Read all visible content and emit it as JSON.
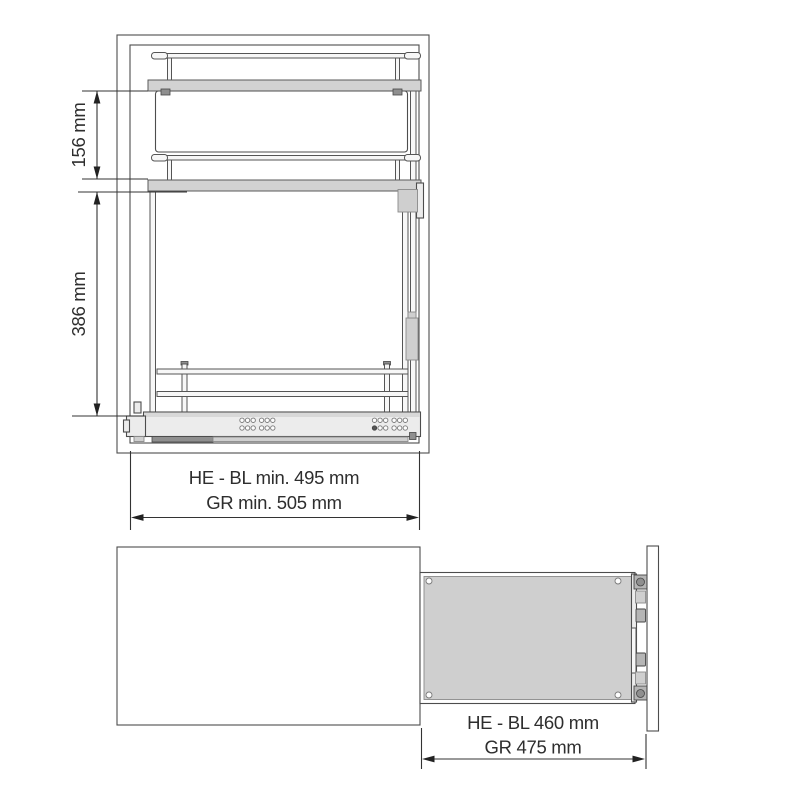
{
  "colors": {
    "line": "#4d4d4d",
    "dimension_line": "#333333",
    "text": "#2e2e2e",
    "shelf_gray": "#d2d2d2",
    "slide_gray": "#ececec",
    "platform_gray": "#cfcfcf",
    "dark_bar_gray": "#8f8f8f",
    "background": "#ffffff"
  },
  "front_view": {
    "dim_vertical_top": "156 mm",
    "dim_vertical_bottom": "386 mm",
    "dim_width_line1": "HE - BL min. 495 mm",
    "dim_width_line2": "GR min. 505 mm"
  },
  "side_view": {
    "dim_line1": "HE - BL 460 mm",
    "dim_line2": "GR 475 mm"
  }
}
